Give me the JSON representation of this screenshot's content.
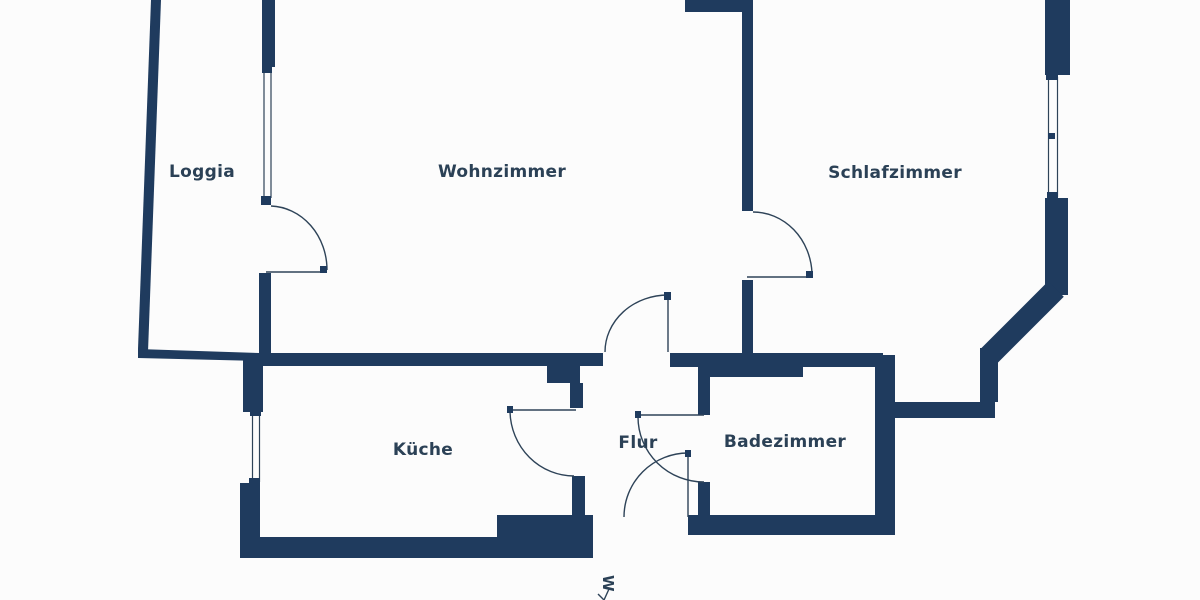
{
  "rooms": [
    {
      "name": "Loggia"
    },
    {
      "name": "Wohnzimmer"
    },
    {
      "name": "Schlafzimmer"
    },
    {
      "name": "Küche"
    },
    {
      "name": "Flur"
    },
    {
      "name": "Badezimmer"
    }
  ],
  "compass": {
    "label": "W"
  },
  "colors": {
    "wall": "#1f3b5e",
    "line": "#2e4358",
    "text": "#2b4156",
    "background": "#fcfcfc"
  }
}
